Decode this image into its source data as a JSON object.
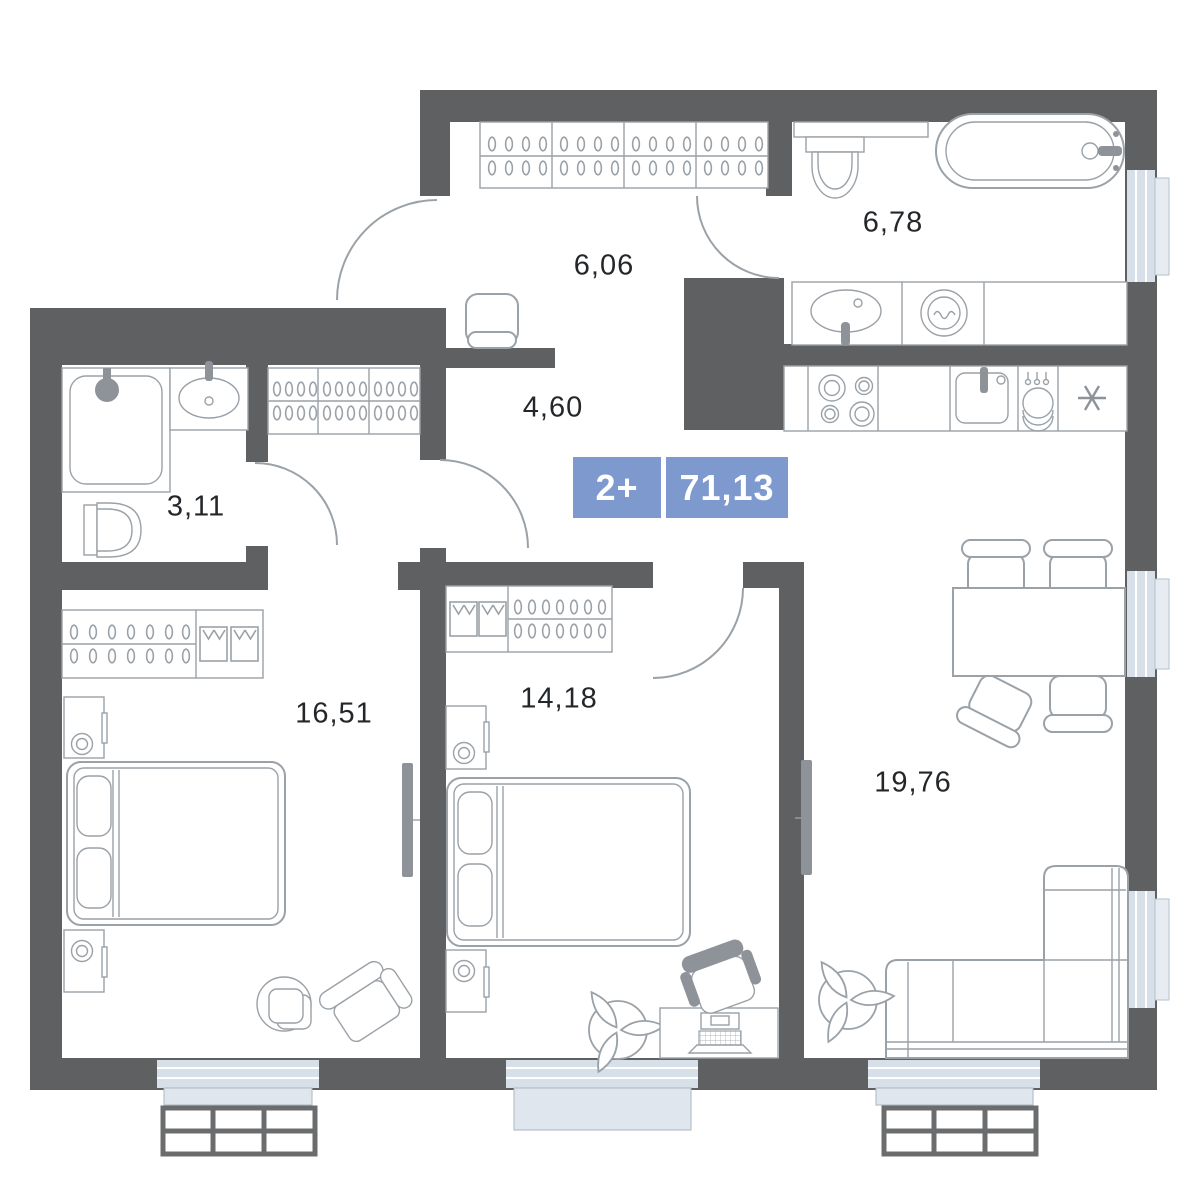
{
  "floorplan": {
    "badge": {
      "rooms_label": "2+",
      "total_area": "71,13",
      "bg_color": "#7e99cd"
    },
    "rooms": [
      {
        "id": "hallway-entry",
        "area": "6,06"
      },
      {
        "id": "bathroom-large",
        "area": "6,78"
      },
      {
        "id": "hallway-inner",
        "area": "4,60"
      },
      {
        "id": "bathroom-small",
        "area": "3,11"
      },
      {
        "id": "bedroom-main",
        "area": "16,51"
      },
      {
        "id": "bedroom-second",
        "area": "14,18"
      },
      {
        "id": "living-kitchen",
        "area": "19,76"
      }
    ],
    "colors": {
      "wall": "#5e6061",
      "furniture_line": "#9aa1a7",
      "window_glass": "#d7dfe8",
      "window_sill": "#dfe6ee",
      "railing": "#6b6c6d",
      "label_text": "#24272a",
      "badge": "#7e99cd"
    }
  }
}
